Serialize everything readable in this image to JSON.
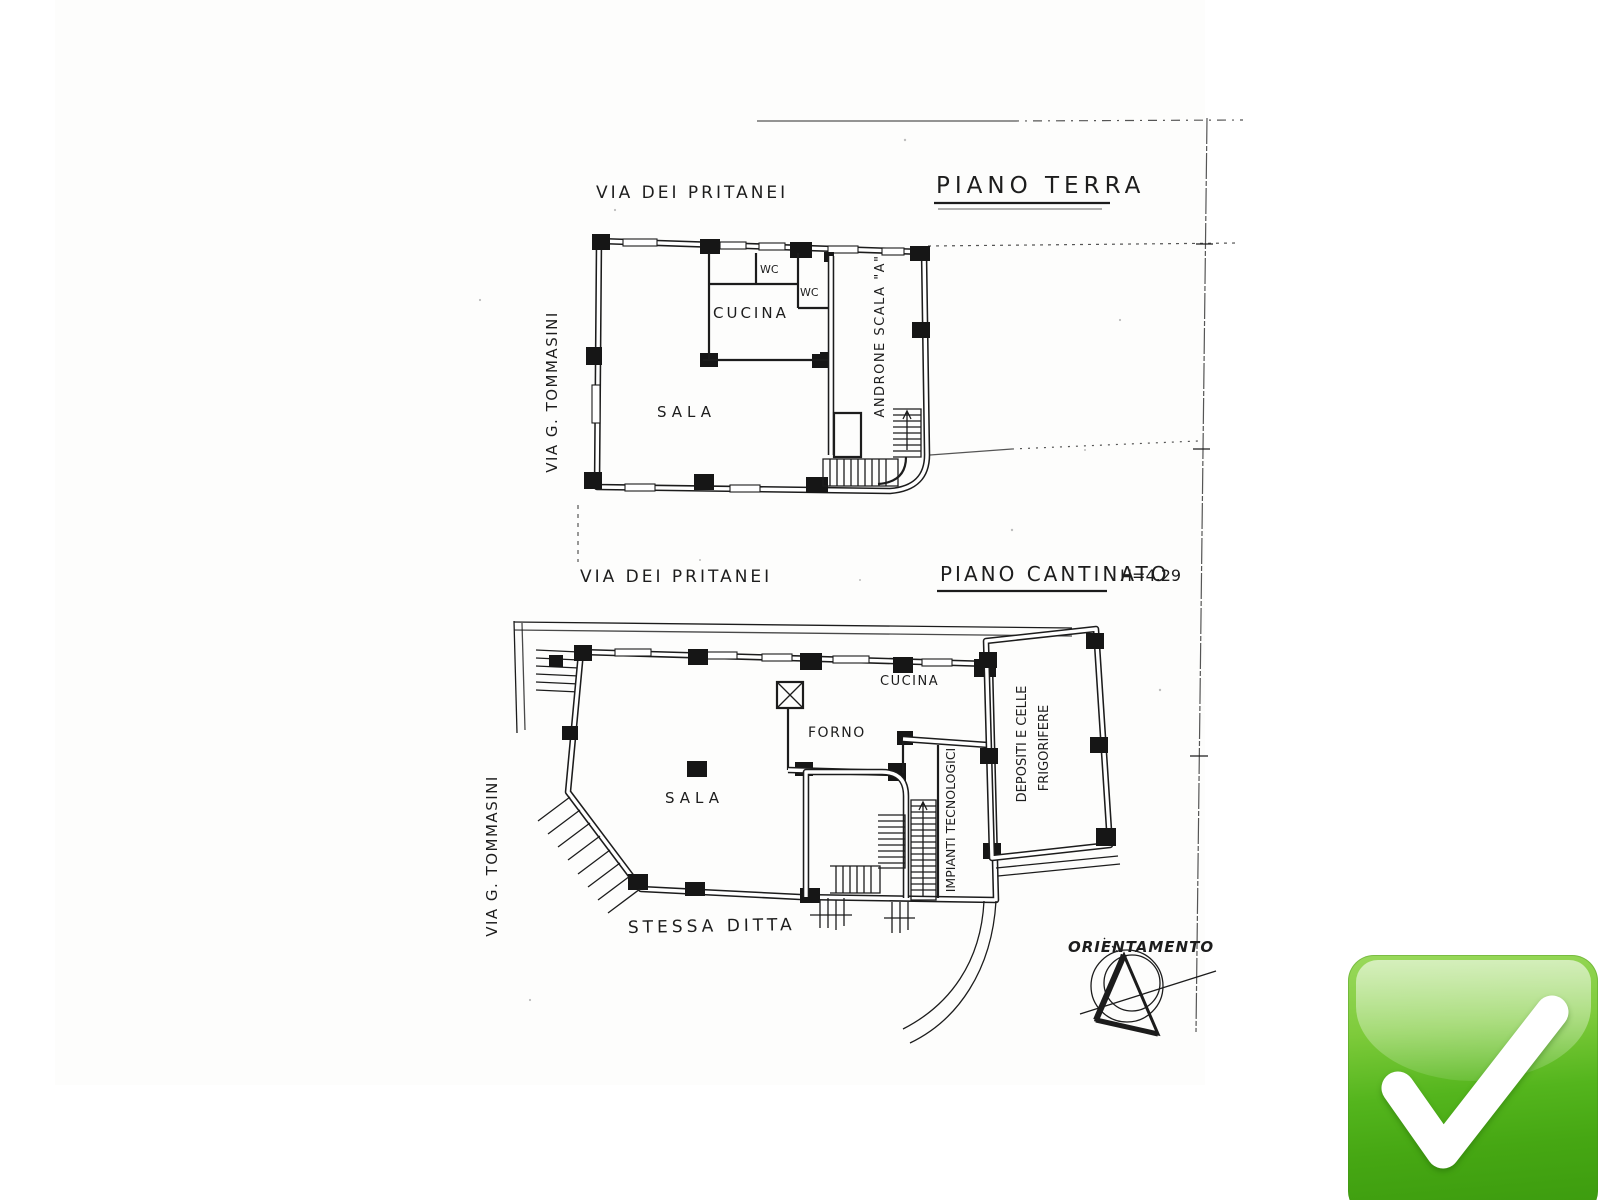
{
  "background": "#ffffff",
  "ink_color": "#1d1d1d",
  "plans": {
    "ground": {
      "title": "PIANO TERRA",
      "street_top": "VIA DEI PRITANEI",
      "street_left": "VIA G. TOMMASINI",
      "rooms": {
        "kitchen": "CUCINA",
        "wc_1": "WC",
        "wc_2": "WC",
        "hall": "SALA",
        "stair_hall": "ANDRONE SCALA \"A\""
      }
    },
    "basement": {
      "title": "PIANO CANTINATO",
      "height_note": "H=4.29",
      "street_top": "VIA DEI PRITANEI",
      "street_left": "VIA G. TOMMASINI",
      "adjacent_note": "STESSA DITTA",
      "rooms": {
        "hall": "SALA",
        "oven": "FORNO",
        "kitchen": "CUCINA",
        "technical": "IMPIANTI TECNOLOGICI",
        "cold_storage_line1": "DEPOSITI E CELLE",
        "cold_storage_line2": "FRIGORIFERE"
      }
    }
  },
  "compass": {
    "label": "ORIENTAMENTO"
  },
  "badge": {
    "icon": "checkmark-icon",
    "colors": {
      "top": "#9ad95c",
      "mid": "#54b51d",
      "bottom": "#3b9a0e",
      "check": "#ffffff"
    }
  }
}
